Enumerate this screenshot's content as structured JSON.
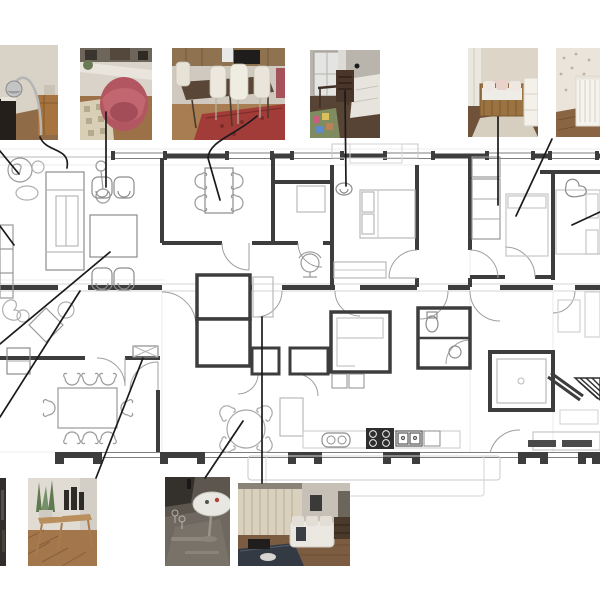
{
  "figure": {
    "kind": "apartment-floor-plan-with-photo-callouts",
    "description": "Black and white architectural floor plan of an apartment, surrounded by interior photographs connected to rooms with black leader lines",
    "visible_text": []
  },
  "colors": {
    "background": "#ffffff",
    "wall_line": "#3d3d3d",
    "furniture_line": "#8c8c8c",
    "sketch_line": "#b9b9b9",
    "faint_line": "#dcdcdc",
    "leader_line": "#1b1b1b",
    "balcony_line": "#c8c8c8"
  },
  "photos": [
    {
      "id": "p1",
      "name": "photo-arc-lamp-corner",
      "description": "Room corner with chrome arc floor lamp, dark fireplace and wooden cabinet"
    },
    {
      "id": "p2",
      "name": "photo-red-armchair",
      "description": "Red velvet tub armchair on wooden floor with patterned cream rug"
    },
    {
      "id": "p3",
      "name": "photo-dining-table",
      "description": "Dining area with dark wood table, white chairs and red oriental rug"
    },
    {
      "id": "p4",
      "name": "photo-bedroom-desk",
      "description": "Bedroom with window, dark wooden chair and desk, bed and colorful play mat"
    },
    {
      "id": "p5",
      "name": "photo-kids-daybed",
      "description": "Child room with wooden daybed, white cushions and white cabinet"
    },
    {
      "id": "p6",
      "name": "photo-nursery-crib",
      "description": "Nursery with white crib against floral wallpaper, cropped by right edge"
    },
    {
      "id": "b0",
      "name": "photo-left-edge-fragment",
      "description": "Dark photo fragment cropped by left edge"
    },
    {
      "id": "b1",
      "name": "photo-console-table",
      "description": "Wooden console table with plants and dark vases on herringbone floor"
    },
    {
      "id": "b2",
      "name": "photo-oval-table",
      "description": "White oval pedestal table on dark polished floor"
    },
    {
      "id": "b3",
      "name": "photo-living-room",
      "description": "Living room with beige curtains, white sofa, dark rug and media cabinet"
    }
  ],
  "callouts": [
    {
      "name": "callout-lamp-to-living-room",
      "path": "M40,137 C46,153 71,147 67,168"
    },
    {
      "name": "callout-armchair",
      "path": "M106,112 L106,187"
    },
    {
      "name": "callout-dining-nook",
      "path": "M257,116 C234,136 209,141 208,158 L220,200"
    },
    {
      "name": "callout-bedroom-desk",
      "path": "M345,91 L346,186"
    },
    {
      "name": "callout-kids-room",
      "path": "M498,117 L498,205"
    },
    {
      "name": "callout-nursery",
      "path": "M552,139 L516,216"
    },
    {
      "name": "callout-right-edge",
      "path": "M600,212 L572,225"
    },
    {
      "name": "callout-left-edge-top",
      "path": "M0,151 L19,174"
    },
    {
      "name": "callout-diagonal-a",
      "path": "M110,252 L0,344"
    },
    {
      "name": "callout-diagonal-b",
      "path": "M80,291 L0,417"
    },
    {
      "name": "callout-left-edge-small",
      "path": "M0,226 L14,245"
    },
    {
      "name": "callout-console",
      "path": "M96,478 L143,358"
    },
    {
      "name": "callout-round-table",
      "path": "M205,478 L243,421"
    },
    {
      "name": "callout-living-photo",
      "path": "M262,483 L262,317"
    }
  ],
  "leader_dots": [
    {
      "name": "callout-dot",
      "x": 357,
      "y": 66
    }
  ],
  "plan": {
    "rooms": [
      "living-room",
      "dining-nook",
      "closet",
      "bedroom-1",
      "corridor",
      "bedroom-2",
      "bedroom-3",
      "lower-living",
      "dining-room",
      "entry-hall",
      "service-core",
      "storage-closets",
      "pantry",
      "kitchen",
      "bathroom",
      "shower-room",
      "wc",
      "balcony-top",
      "balcony-bottom"
    ],
    "furniture": [
      "swirl-lounge-chair",
      "floor-lamp",
      "shelving-unit",
      "armchair-pair",
      "coffee-table",
      "sofa",
      "dining-table-4-chairs",
      "bed",
      "dresser",
      "wardrobe",
      "double-bed",
      "dining-table-8-chairs",
      "round-table-4-chairs",
      "console-table",
      "sideboard",
      "kitchen-island",
      "desk-chair"
    ],
    "fixtures": [
      "windows",
      "door-arcs",
      "sink",
      "stove-4-burners",
      "double-sink",
      "shower-square",
      "toilet",
      "hatched-triangle"
    ]
  }
}
